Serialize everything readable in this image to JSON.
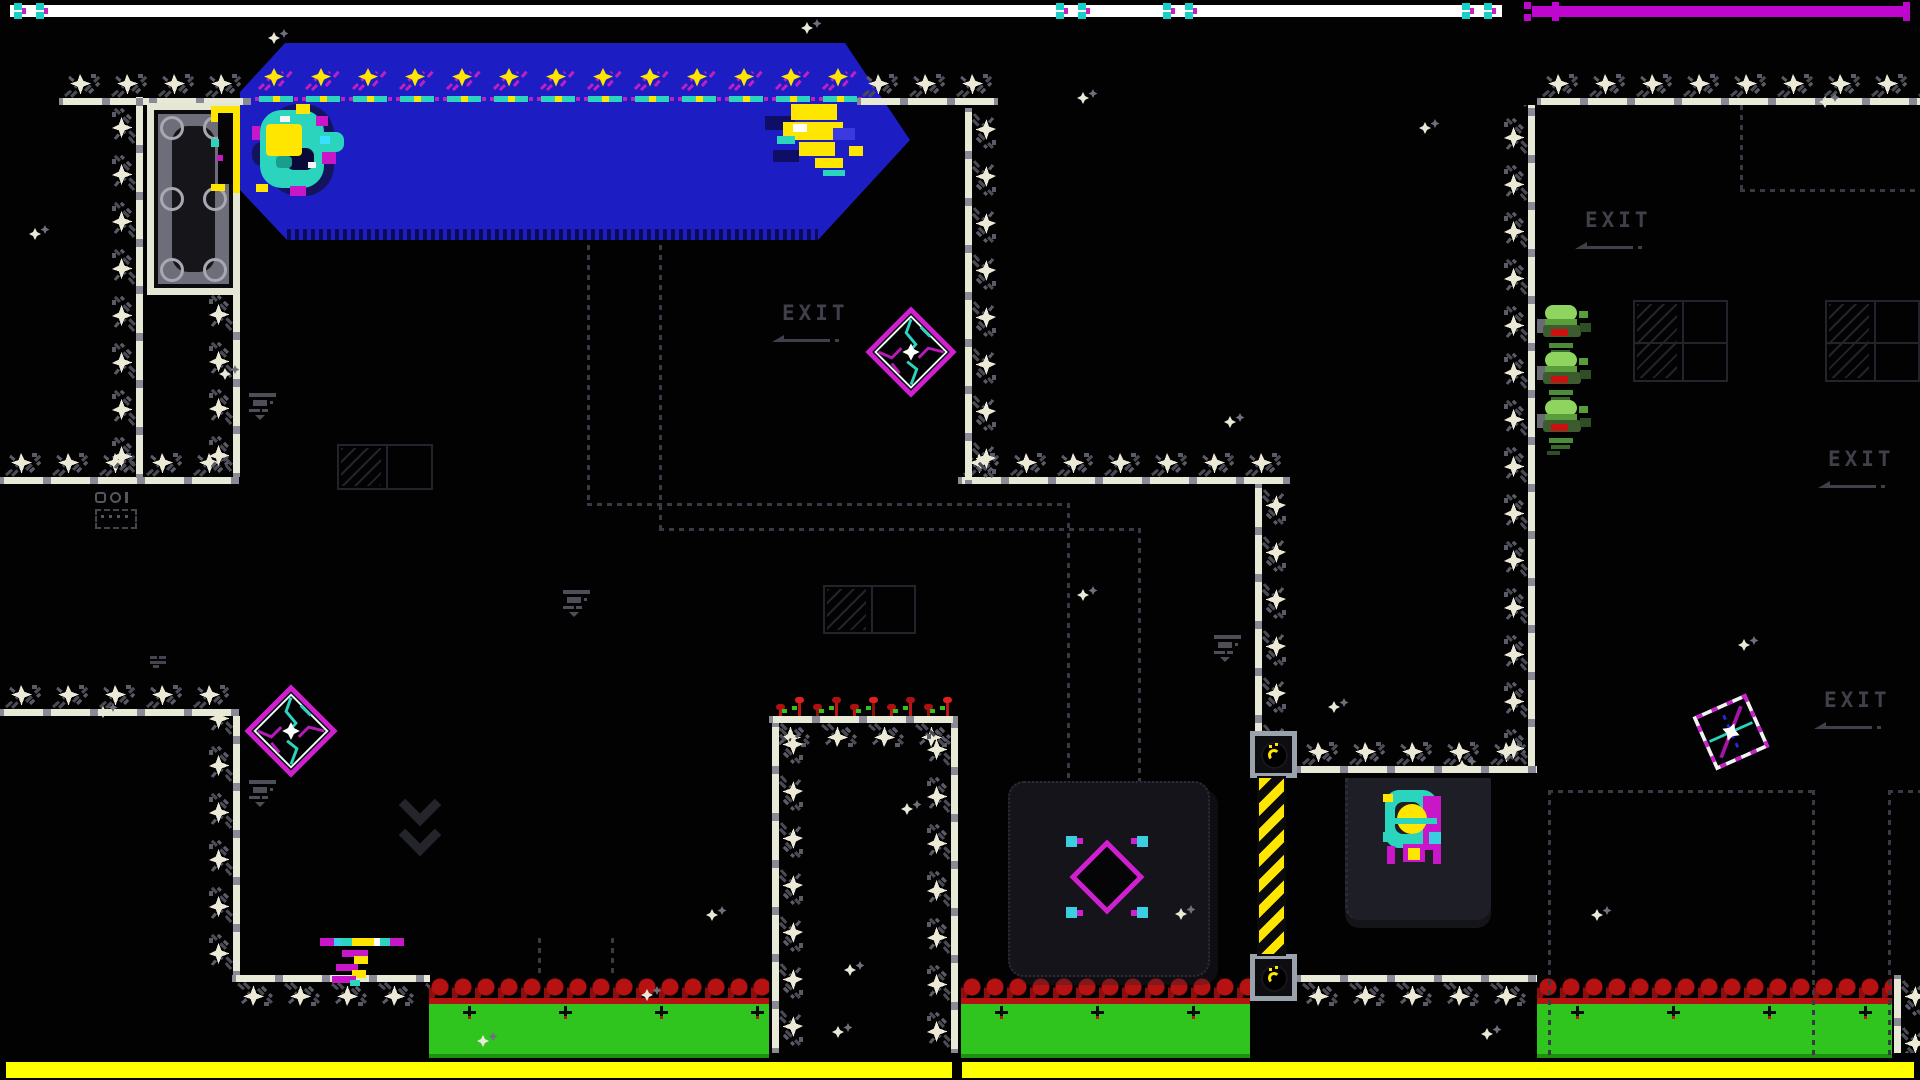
{
  "scene": {
    "width": 1920,
    "height": 1080,
    "background": "#020203"
  },
  "colors": {
    "blue_pool": "#1d1dc4",
    "tile_bar": "#e9e9d8",
    "tile_gray": "#4a4a55",
    "magenta": "#cf1fcf",
    "teal": "#2bd4bd",
    "yellow": "#ffe600",
    "hud_white": "#ffffff",
    "hud_magenta": "#bf06cf",
    "bottom_bar": "#ffff00",
    "grass_green": "#2fc41e",
    "grass_red": "#b61212",
    "exit_text": "#40404a"
  },
  "hud": {
    "top_white_bar": {
      "x": 10,
      "y": 5,
      "w": 1492,
      "h": 12,
      "color": "#ffffff",
      "clusters": [
        14,
        1056,
        1163,
        1462
      ],
      "cluster_cyan": "#19d0c8",
      "cluster_magenta": "#c81ec8"
    },
    "top_magenta_bar": {
      "x": 1532,
      "y": 6,
      "w": 378,
      "h": 11,
      "color": "#bf06cf",
      "crosses": [
        1524,
        1552,
        1903
      ]
    },
    "bottom_bar": {
      "y": 1062,
      "h": 16,
      "color": "#ffff00",
      "segments": [
        [
          6,
          946
        ],
        [
          962,
          952
        ]
      ]
    }
  },
  "exits": [
    {
      "text": "EXIT",
      "x": 782,
      "y": 303
    },
    {
      "text": "EXIT",
      "x": 1585,
      "y": 210
    },
    {
      "text": "EXIT",
      "x": 1828,
      "y": 449
    },
    {
      "text": "EXIT",
      "x": 1824,
      "y": 690
    }
  ],
  "blue_pool": {
    "x": 240,
    "y": 43,
    "w": 670,
    "h": 197,
    "clip": "polygon(45px 0px,605px 0px,670px 97px,578px 197px,47px 197px,0px 147px,0px 49px)",
    "dither": [
      47,
      186,
      531,
      11
    ]
  },
  "pad_row": {
    "x": 253,
    "y": 62,
    "count": 13,
    "step": 47
  },
  "door": {
    "x": 147,
    "y": 103,
    "w": 93,
    "h": 192
  },
  "walls": {
    "h": [
      [
        59,
        98,
        192,
        "up"
      ],
      [
        857,
        98,
        141,
        "up"
      ],
      [
        1537,
        98,
        383,
        "up"
      ],
      [
        0,
        477,
        239,
        "up"
      ],
      [
        958,
        477,
        332,
        "up"
      ],
      [
        0,
        709,
        239,
        "up"
      ],
      [
        769,
        716,
        189,
        "down"
      ],
      [
        1297,
        766,
        240,
        "up"
      ],
      [
        232,
        975,
        198,
        "down"
      ],
      [
        1297,
        975,
        240,
        "down"
      ]
    ],
    "v": [
      [
        136,
        97,
        381,
        "left"
      ],
      [
        233,
        294,
        183,
        "left"
      ],
      [
        233,
        716,
        259,
        "left"
      ],
      [
        772,
        723,
        330,
        "right"
      ],
      [
        951,
        723,
        330,
        "left"
      ],
      [
        965,
        108,
        376,
        "right"
      ],
      [
        1255,
        484,
        248,
        "right"
      ],
      [
        1528,
        105,
        665,
        "left"
      ],
      [
        1894,
        975,
        78,
        "right"
      ]
    ]
  },
  "grass": [
    {
      "x": 429,
      "w": 340
    },
    {
      "x": 961,
      "w": 289
    },
    {
      "x": 1537,
      "w": 355
    }
  ],
  "grass_y": 978,
  "grass_h": 80,
  "plants": {
    "x": 769,
    "y": 678,
    "w": 189,
    "h": 38
  },
  "panels": {
    "switch_panel": {
      "x": 1008,
      "y": 781,
      "w": 198,
      "h": 192
    },
    "machine_panel": {
      "x": 1345,
      "y": 778,
      "w": 143,
      "h": 142
    }
  },
  "switch_diamond": {
    "x": 1052,
    "y": 822,
    "size": 110
  },
  "pads": [
    {
      "x": 1250,
      "y": 731
    },
    {
      "x": 1250,
      "y": 954
    }
  ],
  "pad_size": 47,
  "caution": {
    "x": 1259,
    "y": 778,
    "w": 25,
    "h": 176
  },
  "drones": {
    "x": 1537,
    "tops": [
      303,
      350,
      398
    ],
    "w": 55,
    "h": 58,
    "rects": [
      [
        0,
        16,
        10,
        14,
        "#6a6a74",
        0
      ],
      [
        8,
        2,
        32,
        16,
        "#8ed45e",
        8
      ],
      [
        8,
        16,
        32,
        8,
        "#5a9e3c",
        0
      ],
      [
        6,
        22,
        38,
        12,
        "#3c5c30",
        3
      ],
      [
        14,
        26,
        17,
        7,
        "#cc1111",
        0
      ],
      [
        42,
        8,
        9,
        7,
        "#5a9e3c",
        0
      ],
      [
        43,
        20,
        11,
        9,
        "#2c5024",
        0
      ],
      [
        12,
        40,
        24,
        5,
        "#4c8c3a",
        0
      ],
      [
        14,
        47,
        19,
        4,
        "#39692c",
        0
      ],
      [
        10,
        53,
        13,
        4,
        "#2c5024",
        0
      ]
    ]
  },
  "mines": [
    {
      "cx": 911,
      "cy": 352,
      "size": 96,
      "rot": 0,
      "variant": 1
    },
    {
      "cx": 291,
      "cy": 731,
      "size": 98,
      "rot": 0,
      "variant": 1
    },
    {
      "cx": 1731,
      "cy": 732,
      "size": 92,
      "rot": 21,
      "variant": 2
    }
  ],
  "sprites": {
    "player_blob": {
      "x": 252,
      "y": 98,
      "rects": [
        [
          16,
          6,
          66,
          92,
          "#14145e",
          30
        ],
        [
          0,
          44,
          28,
          24,
          "#14145e",
          10
        ],
        [
          8,
          12,
          64,
          78,
          "#2bd4bd",
          22
        ],
        [
          58,
          34,
          34,
          20,
          "#2bd4bd",
          8
        ],
        [
          34,
          50,
          28,
          22,
          "#0a0a38",
          8
        ],
        [
          14,
          26,
          36,
          32,
          "#ffe600",
          4
        ],
        [
          44,
          6,
          14,
          10,
          "#ffe600",
          0
        ],
        [
          4,
          86,
          12,
          8,
          "#ffe600",
          0
        ],
        [
          64,
          18,
          12,
          10,
          "#c816c8",
          0
        ],
        [
          70,
          54,
          14,
          12,
          "#c816c8",
          0
        ],
        [
          38,
          88,
          16,
          10,
          "#c816c8",
          0
        ],
        [
          0,
          28,
          8,
          14,
          "#c816c8",
          0
        ],
        [
          28,
          18,
          10,
          6,
          "#f4f4f4",
          0
        ],
        [
          56,
          64,
          8,
          6,
          "#f4f4f4",
          0
        ],
        [
          68,
          38,
          10,
          8,
          "#39e0ff",
          0
        ],
        [
          24,
          58,
          16,
          12,
          "#1a9e8c",
          4
        ]
      ]
    },
    "gold_glitch": {
      "x": 765,
      "y": 100,
      "rects": [
        [
          0,
          16,
          30,
          14,
          "#0e0e66",
          0
        ],
        [
          8,
          50,
          26,
          12,
          "#0e0e66",
          0
        ],
        [
          26,
          4,
          46,
          16,
          "#ffe600",
          0
        ],
        [
          18,
          22,
          60,
          18,
          "#ffe600",
          0
        ],
        [
          34,
          42,
          36,
          14,
          "#ffe600",
          0
        ],
        [
          50,
          58,
          28,
          10,
          "#ffe600",
          0
        ],
        [
          28,
          24,
          14,
          8,
          "#ffffff",
          0
        ],
        [
          12,
          36,
          18,
          8,
          "#2bd4bd",
          0
        ],
        [
          58,
          70,
          22,
          6,
          "#2bd4bd",
          0
        ],
        [
          68,
          28,
          22,
          12,
          "#3a3ae0",
          0
        ],
        [
          84,
          46,
          14,
          10,
          "#ffe600",
          0
        ]
      ]
    },
    "umbrella_glitch": {
      "x": 320,
      "y": 936,
      "rects": [
        [
          0,
          2,
          14,
          8,
          "#c816c8",
          0
        ],
        [
          14,
          2,
          8,
          8,
          "#39cfe0",
          0
        ],
        [
          22,
          2,
          10,
          8,
          "#2bd4bd",
          0
        ],
        [
          32,
          2,
          22,
          8,
          "#ffe600",
          0
        ],
        [
          54,
          2,
          6,
          8,
          "#ffffff",
          0
        ],
        [
          60,
          2,
          10,
          8,
          "#2bd4bd",
          0
        ],
        [
          70,
          2,
          14,
          8,
          "#c816c8",
          0
        ],
        [
          22,
          14,
          26,
          7,
          "#c816c8",
          0
        ],
        [
          34,
          20,
          14,
          8,
          "#ffe600",
          0
        ],
        [
          16,
          28,
          22,
          7,
          "#c816c8",
          0
        ],
        [
          32,
          34,
          14,
          8,
          "#ffe600",
          0
        ],
        [
          12,
          40,
          24,
          7,
          "#c816c8",
          0
        ],
        [
          30,
          44,
          10,
          6,
          "#2bd4bd",
          0
        ]
      ]
    },
    "machine": {
      "x": 1381,
      "y": 788,
      "rects": [
        [
          4,
          2,
          52,
          58,
          "#2bd4bd",
          14
        ],
        [
          42,
          8,
          18,
          54,
          "#c816c8",
          0
        ],
        [
          14,
          14,
          26,
          32,
          "#1e1e25",
          8
        ],
        [
          2,
          6,
          10,
          8,
          "#ffe600",
          0
        ],
        [
          16,
          16,
          30,
          30,
          "#ffe600",
          99
        ],
        [
          10,
          30,
          46,
          6,
          "#2bd4bd",
          0
        ],
        [
          22,
          56,
          22,
          18,
          "#c816c8",
          0
        ],
        [
          27,
          60,
          12,
          12,
          "#ffe600",
          0
        ],
        [
          6,
          58,
          8,
          18,
          "#c816c8",
          0
        ],
        [
          52,
          58,
          8,
          18,
          "#c816c8",
          0
        ],
        [
          2,
          44,
          12,
          10,
          "#2bd4bd",
          0
        ],
        [
          48,
          44,
          12,
          12,
          "#39cfe0",
          0
        ]
      ]
    }
  },
  "dotted": [
    {
      "d": "v",
      "x": 587,
      "y": 245,
      "len": 258
    },
    {
      "d": "h",
      "x": 587,
      "y": 503,
      "len": 480
    },
    {
      "d": "v",
      "x": 1067,
      "y": 503,
      "len": 278
    },
    {
      "d": "v",
      "x": 659,
      "y": 245,
      "len": 283
    },
    {
      "d": "h",
      "x": 659,
      "y": 528,
      "len": 479
    },
    {
      "d": "v",
      "x": 1138,
      "y": 528,
      "len": 253
    },
    {
      "d": "v",
      "x": 538,
      "y": 938,
      "len": 40
    },
    {
      "d": "v",
      "x": 611,
      "y": 938,
      "len": 40
    },
    {
      "d": "v",
      "x": 1740,
      "y": 105,
      "len": 84
    },
    {
      "d": "h",
      "x": 1740,
      "y": 189,
      "len": 180
    },
    {
      "d": "h",
      "x": 1548,
      "y": 790,
      "len": 264
    },
    {
      "d": "v",
      "x": 1548,
      "y": 790,
      "len": 266
    },
    {
      "d": "v",
      "x": 1812,
      "y": 790,
      "len": 266
    },
    {
      "d": "h",
      "x": 1888,
      "y": 790,
      "len": 32
    },
    {
      "d": "v",
      "x": 1888,
      "y": 790,
      "len": 266
    }
  ],
  "frames": [
    {
      "x": 337,
      "y": 444,
      "w": 96,
      "h": 46,
      "rows": 1
    },
    {
      "x": 823,
      "y": 585,
      "w": 93,
      "h": 49,
      "rows": 1
    },
    {
      "x": 1633,
      "y": 300,
      "w": 95,
      "h": 82,
      "rows": 2
    },
    {
      "x": 1825,
      "y": 300,
      "w": 95,
      "h": 82,
      "rows": 2
    }
  ],
  "icons": {
    "shelves": [
      [
        247,
        393
      ],
      [
        247,
        780
      ],
      [
        1212,
        635
      ],
      [
        561,
        590
      ]
    ],
    "glg": {
      "x": 95,
      "y": 492
    },
    "chevron": {
      "x": 405,
      "y": 790
    },
    "mini": {
      "x": 150,
      "y": 656
    }
  },
  "sparkles": [
    [
      267,
      28
    ],
    [
      800,
      18
    ],
    [
      1076,
      88
    ],
    [
      1418,
      118
    ],
    [
      1818,
      92
    ],
    [
      28,
      224
    ],
    [
      218,
      364
    ],
    [
      1223,
      412
    ],
    [
      1076,
      585
    ],
    [
      1737,
      635
    ],
    [
      96,
      702
    ],
    [
      900,
      799
    ],
    [
      1327,
      697
    ],
    [
      1455,
      756
    ],
    [
      843,
      960
    ],
    [
      1590,
      905
    ],
    [
      476,
      1031
    ],
    [
      831,
      1022
    ],
    [
      1174,
      904
    ],
    [
      640,
      985
    ],
    [
      1480,
      1024
    ],
    [
      705,
      905
    ]
  ]
}
